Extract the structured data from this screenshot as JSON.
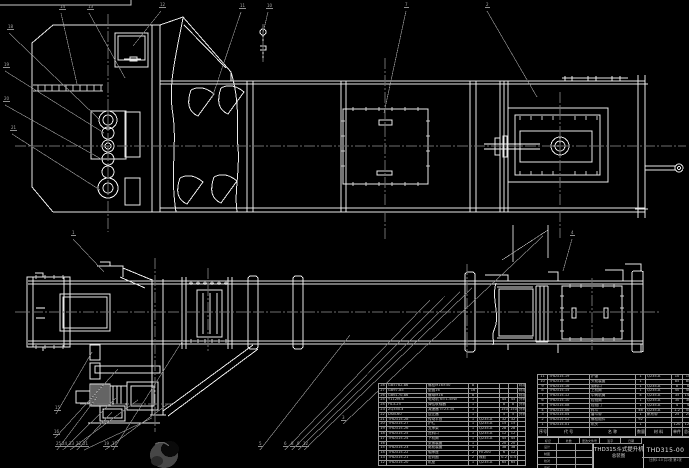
{
  "colors": {
    "background": "#000000",
    "line": "#e9e9e9",
    "leader_gray": "#8a8a8a",
    "text_gray": "#c9c9c9"
  },
  "drawing": {
    "title": "THD315斗式提升机",
    "subtitle": "总装图",
    "drawing_no": "THD315-00",
    "org_line": "比例1:10 共1张 第1张",
    "sign_row": [
      "标记",
      "处数",
      "更改文件号",
      "签字",
      "日期"
    ],
    "sign_grid": [
      "设计",
      "制图",
      "校对",
      "审核"
    ]
  },
  "bom": {
    "weight_header": "重量",
    "header": {
      "no": "序号",
      "code": "代  号",
      "name": "名  称",
      "qty": "数量",
      "mat": "材  料",
      "w1": "单件",
      "w2": "总计",
      "note": "附注"
    },
    "left_rows": [
      {
        "no": "28",
        "code": "GB5782-86",
        "name": "螺栓M16×50",
        "qty": "8",
        "mat": "",
        "w1": "",
        "w2": "",
        "note": "标准件"
      },
      {
        "no": "27",
        "code": "GB97-85",
        "name": "垫圈16",
        "qty": "16",
        "mat": "",
        "w1": "",
        "w2": "",
        "note": "标准件"
      },
      {
        "no": "26",
        "code": "GB6170-86",
        "name": "螺母M16",
        "qty": "8",
        "mat": "",
        "w1": "",
        "w2": "",
        "note": "标准件"
      },
      {
        "no": "25",
        "code": "Y112M-6",
        "name": "电动机 N=1.5kW",
        "qty": "1",
        "mat": "",
        "w1": "45",
        "w2": "45",
        "note": "外购"
      },
      {
        "no": "24",
        "code": "HL3-25",
        "name": "弹性联轴器",
        "qty": "1",
        "mat": "",
        "w1": "8",
        "w2": "8",
        "note": "外购"
      },
      {
        "no": "23",
        "code": "ZQ350-Ⅱ",
        "name": "减速器 i=23.34",
        "qty": "1",
        "mat": "",
        "w1": "150",
        "w2": "150",
        "note": "外购"
      },
      {
        "no": "22",
        "code": "DSN-60",
        "name": "逆止器",
        "qty": "1",
        "mat": "",
        "w1": "5",
        "w2": "5",
        "note": "外购"
      },
      {
        "no": "21",
        "code": "THD315-28",
        "name": "传动平台",
        "qty": "1",
        "mat": "Q235-A",
        "w1": "32",
        "w2": "32",
        "note": ""
      },
      {
        "no": "20",
        "code": "THD315-27",
        "name": "护栏",
        "qty": "1",
        "mat": "Q235-A",
        "w1": "15",
        "w2": "15",
        "note": ""
      },
      {
        "no": "19",
        "code": "THD315-26",
        "name": "支承架",
        "qty": "1",
        "mat": "Q235-A",
        "w1": "28",
        "w2": "28",
        "note": ""
      },
      {
        "no": "18",
        "code": "THD315-25",
        "name": "进料口",
        "qty": "1",
        "mat": "Q235-A",
        "w1": "12",
        "w2": "12",
        "note": ""
      },
      {
        "no": "17",
        "code": "THD315-24",
        "name": "下机筒",
        "qty": "1",
        "mat": "Q235-A",
        "w1": "45",
        "w2": "45",
        "note": ""
      },
      {
        "no": "16",
        "code": "",
        "name": "张紧装置",
        "qty": "1",
        "mat": "",
        "w1": "20",
        "w2": "20",
        "note": ""
      },
      {
        "no": "15",
        "code": "THD315-23",
        "name": "尾轮装置",
        "qty": "1",
        "mat": "",
        "w1": "38",
        "w2": "38",
        "note": ""
      },
      {
        "no": "14",
        "code": "THD315-22",
        "name": "轴承座",
        "qty": "2",
        "mat": "HT200",
        "w1": "6",
        "w2": "12",
        "note": ""
      },
      {
        "no": "13",
        "code": "THD315-21",
        "name": "密封圈",
        "qty": "2",
        "mat": "橡胶",
        "w1": "0.2",
        "w2": "0.4",
        "note": ""
      },
      {
        "no": "12",
        "code": "THD315-20",
        "name": "机座",
        "qty": "1",
        "mat": "Q235-A",
        "w1": "65",
        "w2": "65",
        "note": ""
      }
    ],
    "right_rows": [
      {
        "no": "11",
        "code": "THD315-19",
        "name": "护罩",
        "qty": "1",
        "mat": "Q235-A",
        "w1": "10",
        "w2": "10",
        "note": ""
      },
      {
        "no": "10",
        "code": "THD315-18",
        "name": "头轮装置",
        "qty": "1",
        "mat": "",
        "w1": "85",
        "w2": "85",
        "note": ""
      },
      {
        "no": "9",
        "code": "THD315-16",
        "name": "卸料口",
        "qty": "1",
        "mat": "Q235-A",
        "w1": "8",
        "w2": "8",
        "note": ""
      },
      {
        "no": "8",
        "code": "THD315-15",
        "name": "上机筒",
        "qty": "1",
        "mat": "Q235-A",
        "w1": "40",
        "w2": "40",
        "note": ""
      },
      {
        "no": "7",
        "code": "THD315-12",
        "name": "中间机筒",
        "qty": "4",
        "mat": "Q235-A",
        "w1": "35",
        "w2": "140",
        "note": ""
      },
      {
        "no": "6",
        "code": "THD315-10",
        "name": "检视筒",
        "qty": "1",
        "mat": "Q235-A",
        "w1": "30",
        "w2": "30",
        "note": ""
      },
      {
        "no": "5",
        "code": "THD315-08",
        "name": "检视门",
        "qty": "1",
        "mat": "Q235-A",
        "w1": "4",
        "w2": "4",
        "note": ""
      },
      {
        "no": "4",
        "code": "THD315-06",
        "name": "料斗",
        "qty": "46",
        "mat": "Q235-A",
        "w1": "1.2",
        "w2": "55",
        "note": ""
      },
      {
        "no": "3",
        "code": "THD315-04",
        "name": "畚斗带",
        "qty": "1",
        "mat": "帆布带",
        "w1": "25",
        "w2": "25",
        "note": ""
      },
      {
        "no": "2",
        "code": "THD315-02",
        "name": "螺栓组件",
        "qty": "92",
        "mat": "",
        "w1": "",
        "w2": "",
        "note": "标准件"
      },
      {
        "no": "1",
        "code": "THD315-01",
        "name": "机头",
        "qty": "1",
        "mat": "",
        "w1": "120",
        "w2": "120",
        "note": ""
      }
    ]
  },
  "callouts": [
    {
      "label": "14",
      "x": 59,
      "y": 9,
      "tx": 77,
      "ty": 84
    },
    {
      "label": "13",
      "x": 87,
      "y": 9,
      "tx": 125,
      "ty": 78
    },
    {
      "label": "12",
      "x": 159,
      "y": 7,
      "tx": 133,
      "ty": 46
    },
    {
      "label": "11",
      "x": 239,
      "y": 8,
      "tx": 212,
      "ty": 98
    },
    {
      "label": "10",
      "x": 266,
      "y": 8,
      "tx": 263,
      "ty": 33
    },
    {
      "label": "7",
      "x": 404,
      "y": 7,
      "tx": 384,
      "ty": 113
    },
    {
      "label": "2",
      "x": 485,
      "y": 7,
      "tx": 537,
      "ty": 97
    },
    {
      "label": "18",
      "x": 7,
      "y": 29,
      "tx": 100,
      "ty": 120
    },
    {
      "label": "19",
      "x": 3,
      "y": 67,
      "tx": 104,
      "ty": 133
    },
    {
      "label": "20",
      "x": 3,
      "y": 101,
      "tx": 103,
      "ty": 160
    },
    {
      "label": "21",
      "x": 10,
      "y": 130,
      "tx": 100,
      "ty": 190
    },
    {
      "label": "1",
      "x": 71,
      "y": 235,
      "tx": 104,
      "ty": 272
    },
    {
      "label": "4",
      "x": 570,
      "y": 235,
      "tx": 563,
      "ty": 271
    },
    {
      "label": "3",
      "x": 341,
      "y": 420,
      "tx": 543,
      "ty": 236
    },
    {
      "label": "25",
      "x": 55,
      "y": 446,
      "tx": 97,
      "ty": 397
    },
    {
      "label": "24",
      "x": 61,
      "y": 446,
      "tx": 116,
      "ty": 398
    },
    {
      "label": "23",
      "x": 68,
      "y": 446,
      "tx": 138,
      "ty": 400
    },
    {
      "label": "22",
      "x": 75,
      "y": 446,
      "tx": 112,
      "ty": 412
    },
    {
      "label": "21",
      "x": 82,
      "y": 446,
      "tx": 152,
      "ty": 418
    },
    {
      "label": "19",
      "x": 103,
      "y": 446,
      "tx": 168,
      "ty": 404
    },
    {
      "label": "17",
      "x": 111,
      "y": 446,
      "tx": 183,
      "ty": 340
    },
    {
      "label": "15",
      "x": 54,
      "y": 410,
      "tx": 92,
      "ty": 352
    },
    {
      "label": "16",
      "x": 53,
      "y": 434,
      "tx": 118,
      "ty": 369
    },
    {
      "label": "5",
      "x": 258,
      "y": 446,
      "tx": 350,
      "ty": 335
    },
    {
      "label": "6",
      "x": 283,
      "y": 446,
      "tx": 430,
      "ty": 300
    },
    {
      "label": "8",
      "x": 290,
      "y": 446,
      "tx": 445,
      "ty": 296
    },
    {
      "label": "9",
      "x": 296,
      "y": 446,
      "tx": 460,
      "ty": 292
    },
    {
      "label": "12",
      "x": 302,
      "y": 446,
      "tx": 472,
      "ty": 288
    }
  ]
}
